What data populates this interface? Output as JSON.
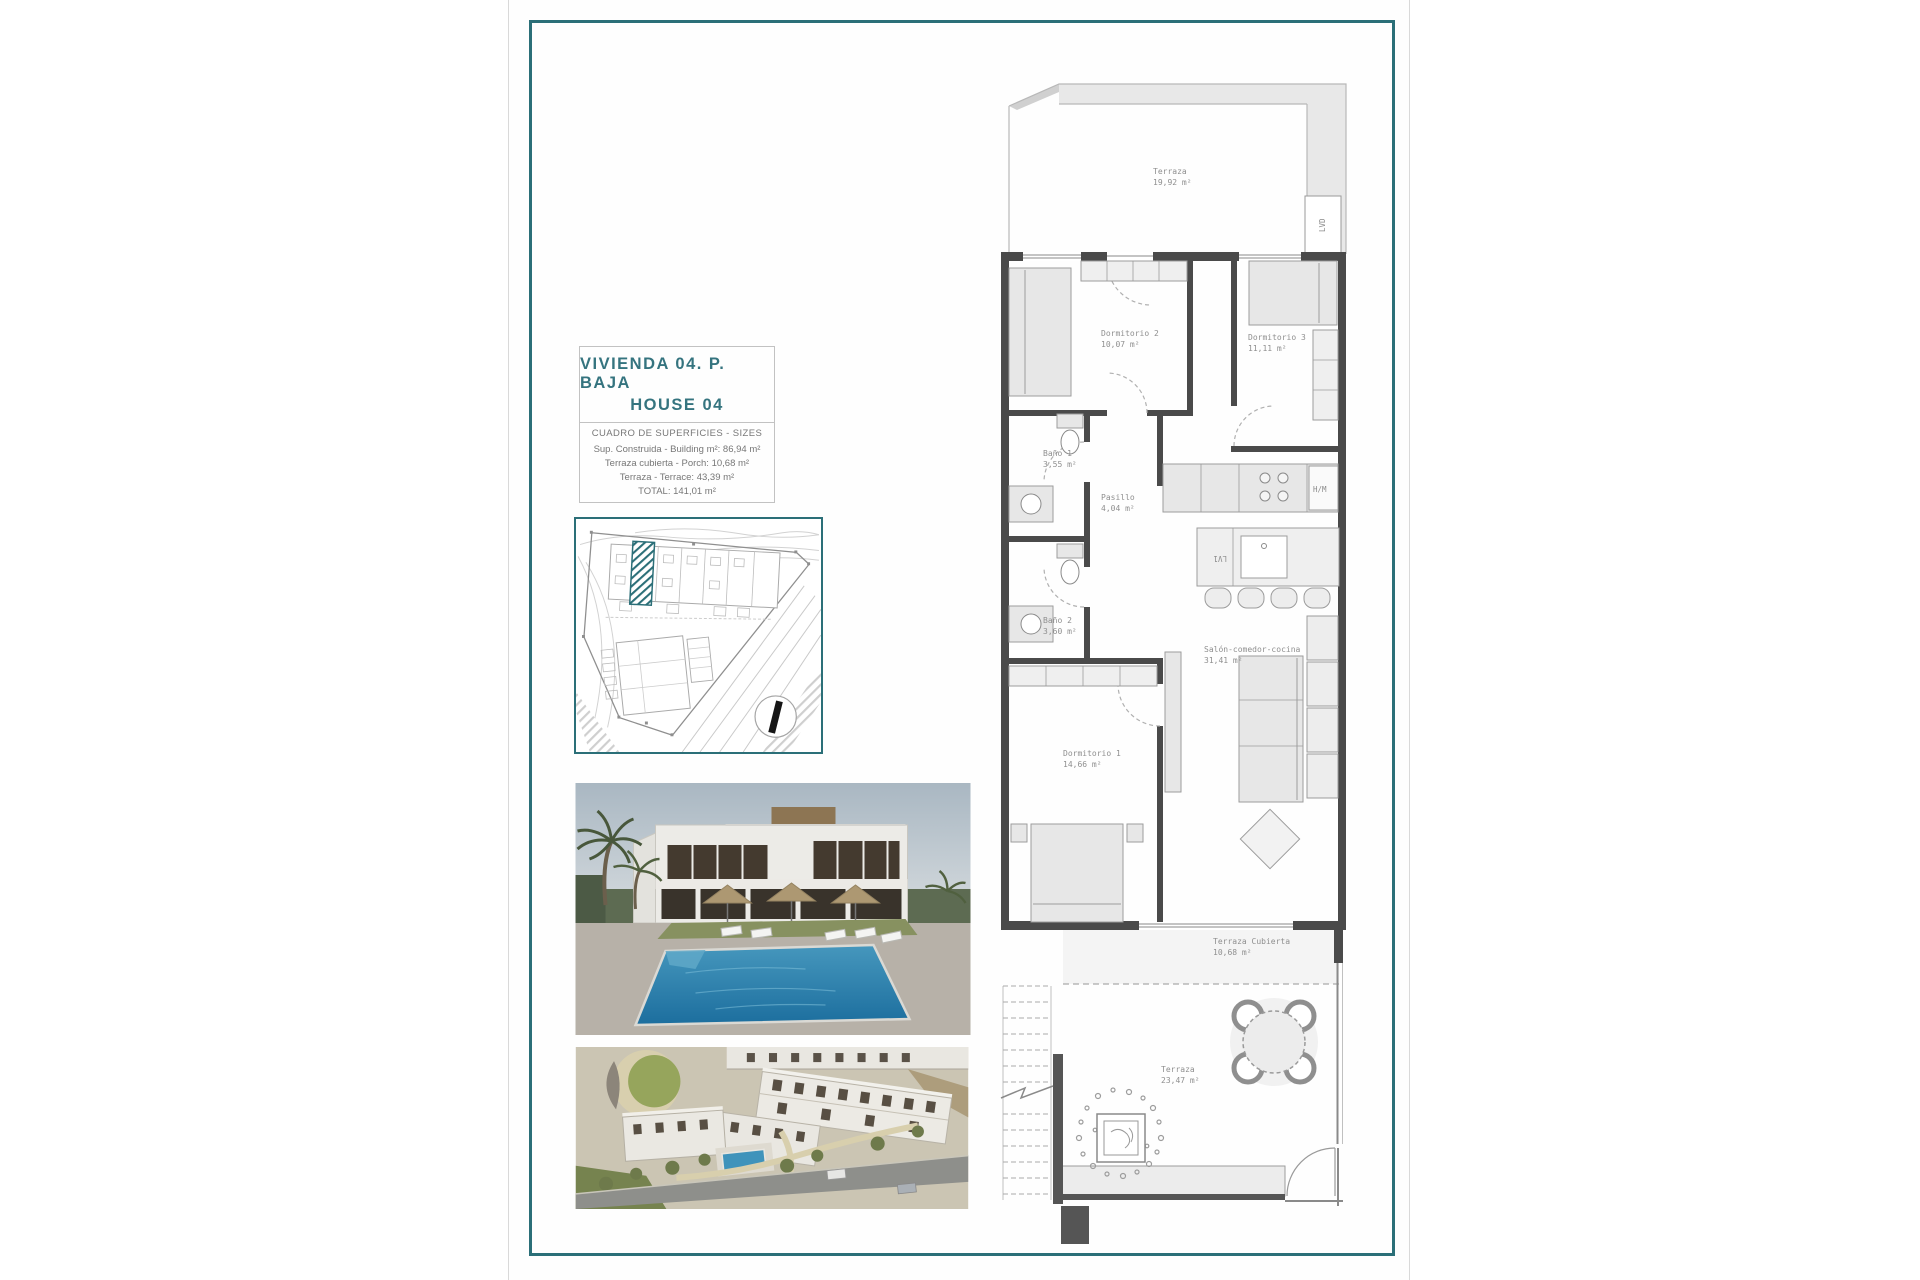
{
  "title_block": {
    "line1": "VIVIENDA 04. P. BAJA",
    "line2": "HOUSE 04"
  },
  "sizes_table": {
    "header": "CUADRO DE SUPERFICIES  - SIZES",
    "rows": [
      "Sup. Construida  - Building m²: 86,94 m²",
      "Terraza cubierta  - Porch: 10,68 m²",
      "Terraza  -  Terrace: 43,39 m²",
      "TOTAL:  141,01 m²"
    ]
  },
  "floorplan": {
    "rooms": [
      {
        "id": "terraza-top",
        "name": "Terraza",
        "area": "19,92 m²"
      },
      {
        "id": "dormitorio-2",
        "name": "Dormitorio 2",
        "area": "10,07 m²"
      },
      {
        "id": "dormitorio-3",
        "name": "Dormitorio 3",
        "area": "11,11 m²"
      },
      {
        "id": "bano-1",
        "name": "Baño 1",
        "area": "3,55 m²"
      },
      {
        "id": "pasillo",
        "name": "Pasillo",
        "area": "4,04 m²"
      },
      {
        "id": "bano-2",
        "name": "Baño 2",
        "area": "3,60 m²"
      },
      {
        "id": "salon",
        "name": "Salón-comedor-cocina",
        "area": "31,41 m²"
      },
      {
        "id": "dormitorio-1",
        "name": "Dormitorio 1",
        "area": "14,66 m²"
      },
      {
        "id": "terraza-cubierta",
        "name": "Terraza Cubierta",
        "area": "10,68 m²"
      },
      {
        "id": "terraza-bottom",
        "name": "Terraza",
        "area": "23,47 m²"
      }
    ],
    "appliance_labels": {
      "laundry": "LVD",
      "tall_units": "H/M",
      "dishwasher": "LV1"
    }
  },
  "colors": {
    "frame_teal": "#2b6f78",
    "title_teal": "#35747f",
    "wall_gray": "#4a4a4a",
    "site_highlight_teal": "#2b6f78"
  }
}
